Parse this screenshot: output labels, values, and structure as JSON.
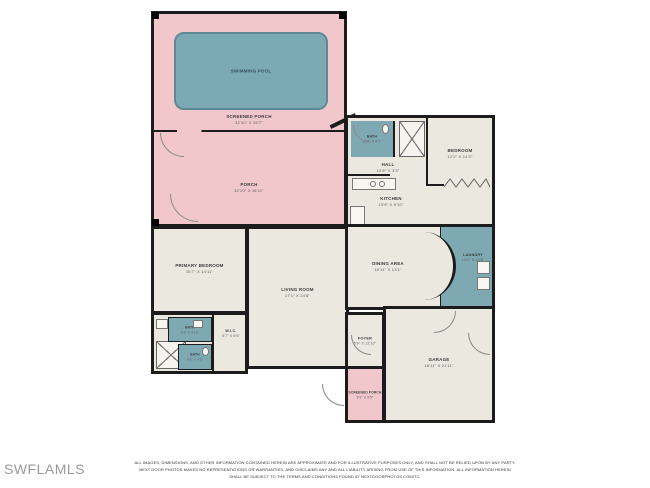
{
  "watermark": "SWFLAMLS",
  "disclaimer": {
    "line1": "ALL IMAGES, DIMENSIONS, AND OTHER INFORMATION CONTAINED HEREIN ARE APPROXIMATE AND FOR ILLUSTRATIVE PURPOSES ONLY, AND SHALL NOT BE RELIED UPON BY ANY PARTY.",
    "line2": "NEXT DOOR PHOTOS MAKES NO REPRESENTATIONS OR WARRANTIES, AND DISCLAIMS ANY AND ALL LIABILITY ARISING FROM USE OF THIS INFORMATION. ALL INFORMATION HEREIN",
    "line3": "SHALL BE SUBJECT TO THE TERMS AND CONDITIONS FOUND AT NEXTDOORPHOTOS.COM/TC."
  },
  "colors": {
    "porch_pink": "#F1C7CB",
    "pool_teal": "#7BA9B4",
    "room_teal": "#7FA9B2",
    "floor_beige": "#EAE8DF",
    "wall": "#1C1C1C",
    "watermark_gray": "#9A9A9A"
  },
  "rooms": {
    "swimming_pool": {
      "label": "SWIMMING POOL",
      "dims": ""
    },
    "screened_porch_top": {
      "label": "SCREENED PORCH",
      "dims": "32'10\" X 25'7\""
    },
    "porch": {
      "label": "PORCH",
      "dims": "32'10\" X 16'11\""
    },
    "bath_1": {
      "label": "BATH",
      "dims": "10'6\" X 6'1\""
    },
    "hall": {
      "label": "HALL",
      "dims": "12'8\" X 3'3\""
    },
    "bedroom": {
      "label": "BEDROOM",
      "dims": "12'2\" X 14'3\""
    },
    "kitchen": {
      "label": "KITCHEN",
      "dims": "13'9\" X 9'10\""
    },
    "primary_bedroom": {
      "label": "PRIMARY BEDROOM",
      "dims": "15'7\" X 14'11\""
    },
    "living_room": {
      "label": "LIVING ROOM",
      "dims": "17'1\" X 24'8\""
    },
    "dining_area": {
      "label": "DINING AREA",
      "dims": "16'11\" X 13'1\""
    },
    "laundry": {
      "label": "LAUNDRY",
      "dims": "13'2\" X 13'8\""
    },
    "bath_2": {
      "label": "BATH",
      "dims": "9'9\" X 4'10\""
    },
    "bath_3": {
      "label": "BATH",
      "dims": "9'9\" X 4'5\""
    },
    "wic": {
      "label": "W.I.C.",
      "dims": "5'7\" X 9'5\""
    },
    "foyer": {
      "label": "FOYER",
      "dims": "5'9\" X 12'10\""
    },
    "garage": {
      "label": "GARAGE",
      "dims": "18'11\" X 21'11\""
    },
    "screened_porch_bottom": {
      "label": "SCREENED PORCH",
      "dims": "5'9\" X 9'5\""
    }
  }
}
